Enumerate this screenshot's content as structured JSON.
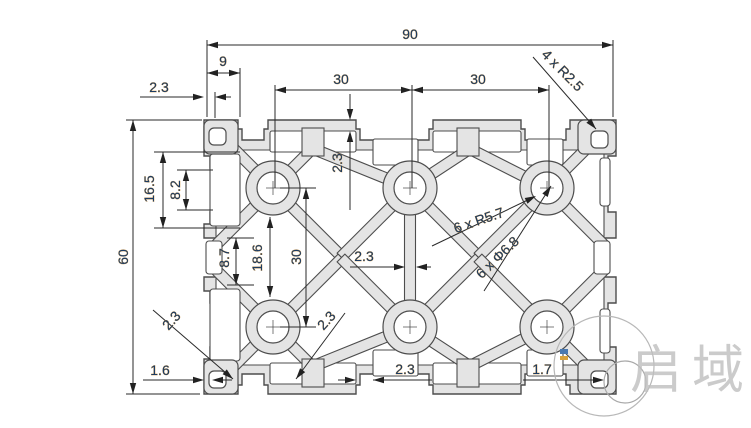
{
  "drawing": {
    "dims": {
      "overall_width": "90",
      "top_offset": "9",
      "wall_top_left": "2.3",
      "slot_pitch_1": "30",
      "slot_pitch_2": "30",
      "corner_holes": "4 x R2.5",
      "top_lip": "2.3",
      "overall_height": "60",
      "side_slot_outer": "16.5",
      "side_slot_opening": "8.2",
      "side_pocket": "8.7",
      "web_span": "18.6",
      "row_pitch": "30",
      "center_web": "2.3",
      "boss_radius": "6 x R5.7",
      "hole_diameter": "6 x Φ6.8",
      "diag_web_left": "2.3",
      "diag_web_right": "2.3",
      "bottom_wall_left": "1.6",
      "bottom_web": "2.3",
      "bottom_wall_right": "1.7"
    },
    "watermark": {
      "brand": "启域"
    }
  }
}
